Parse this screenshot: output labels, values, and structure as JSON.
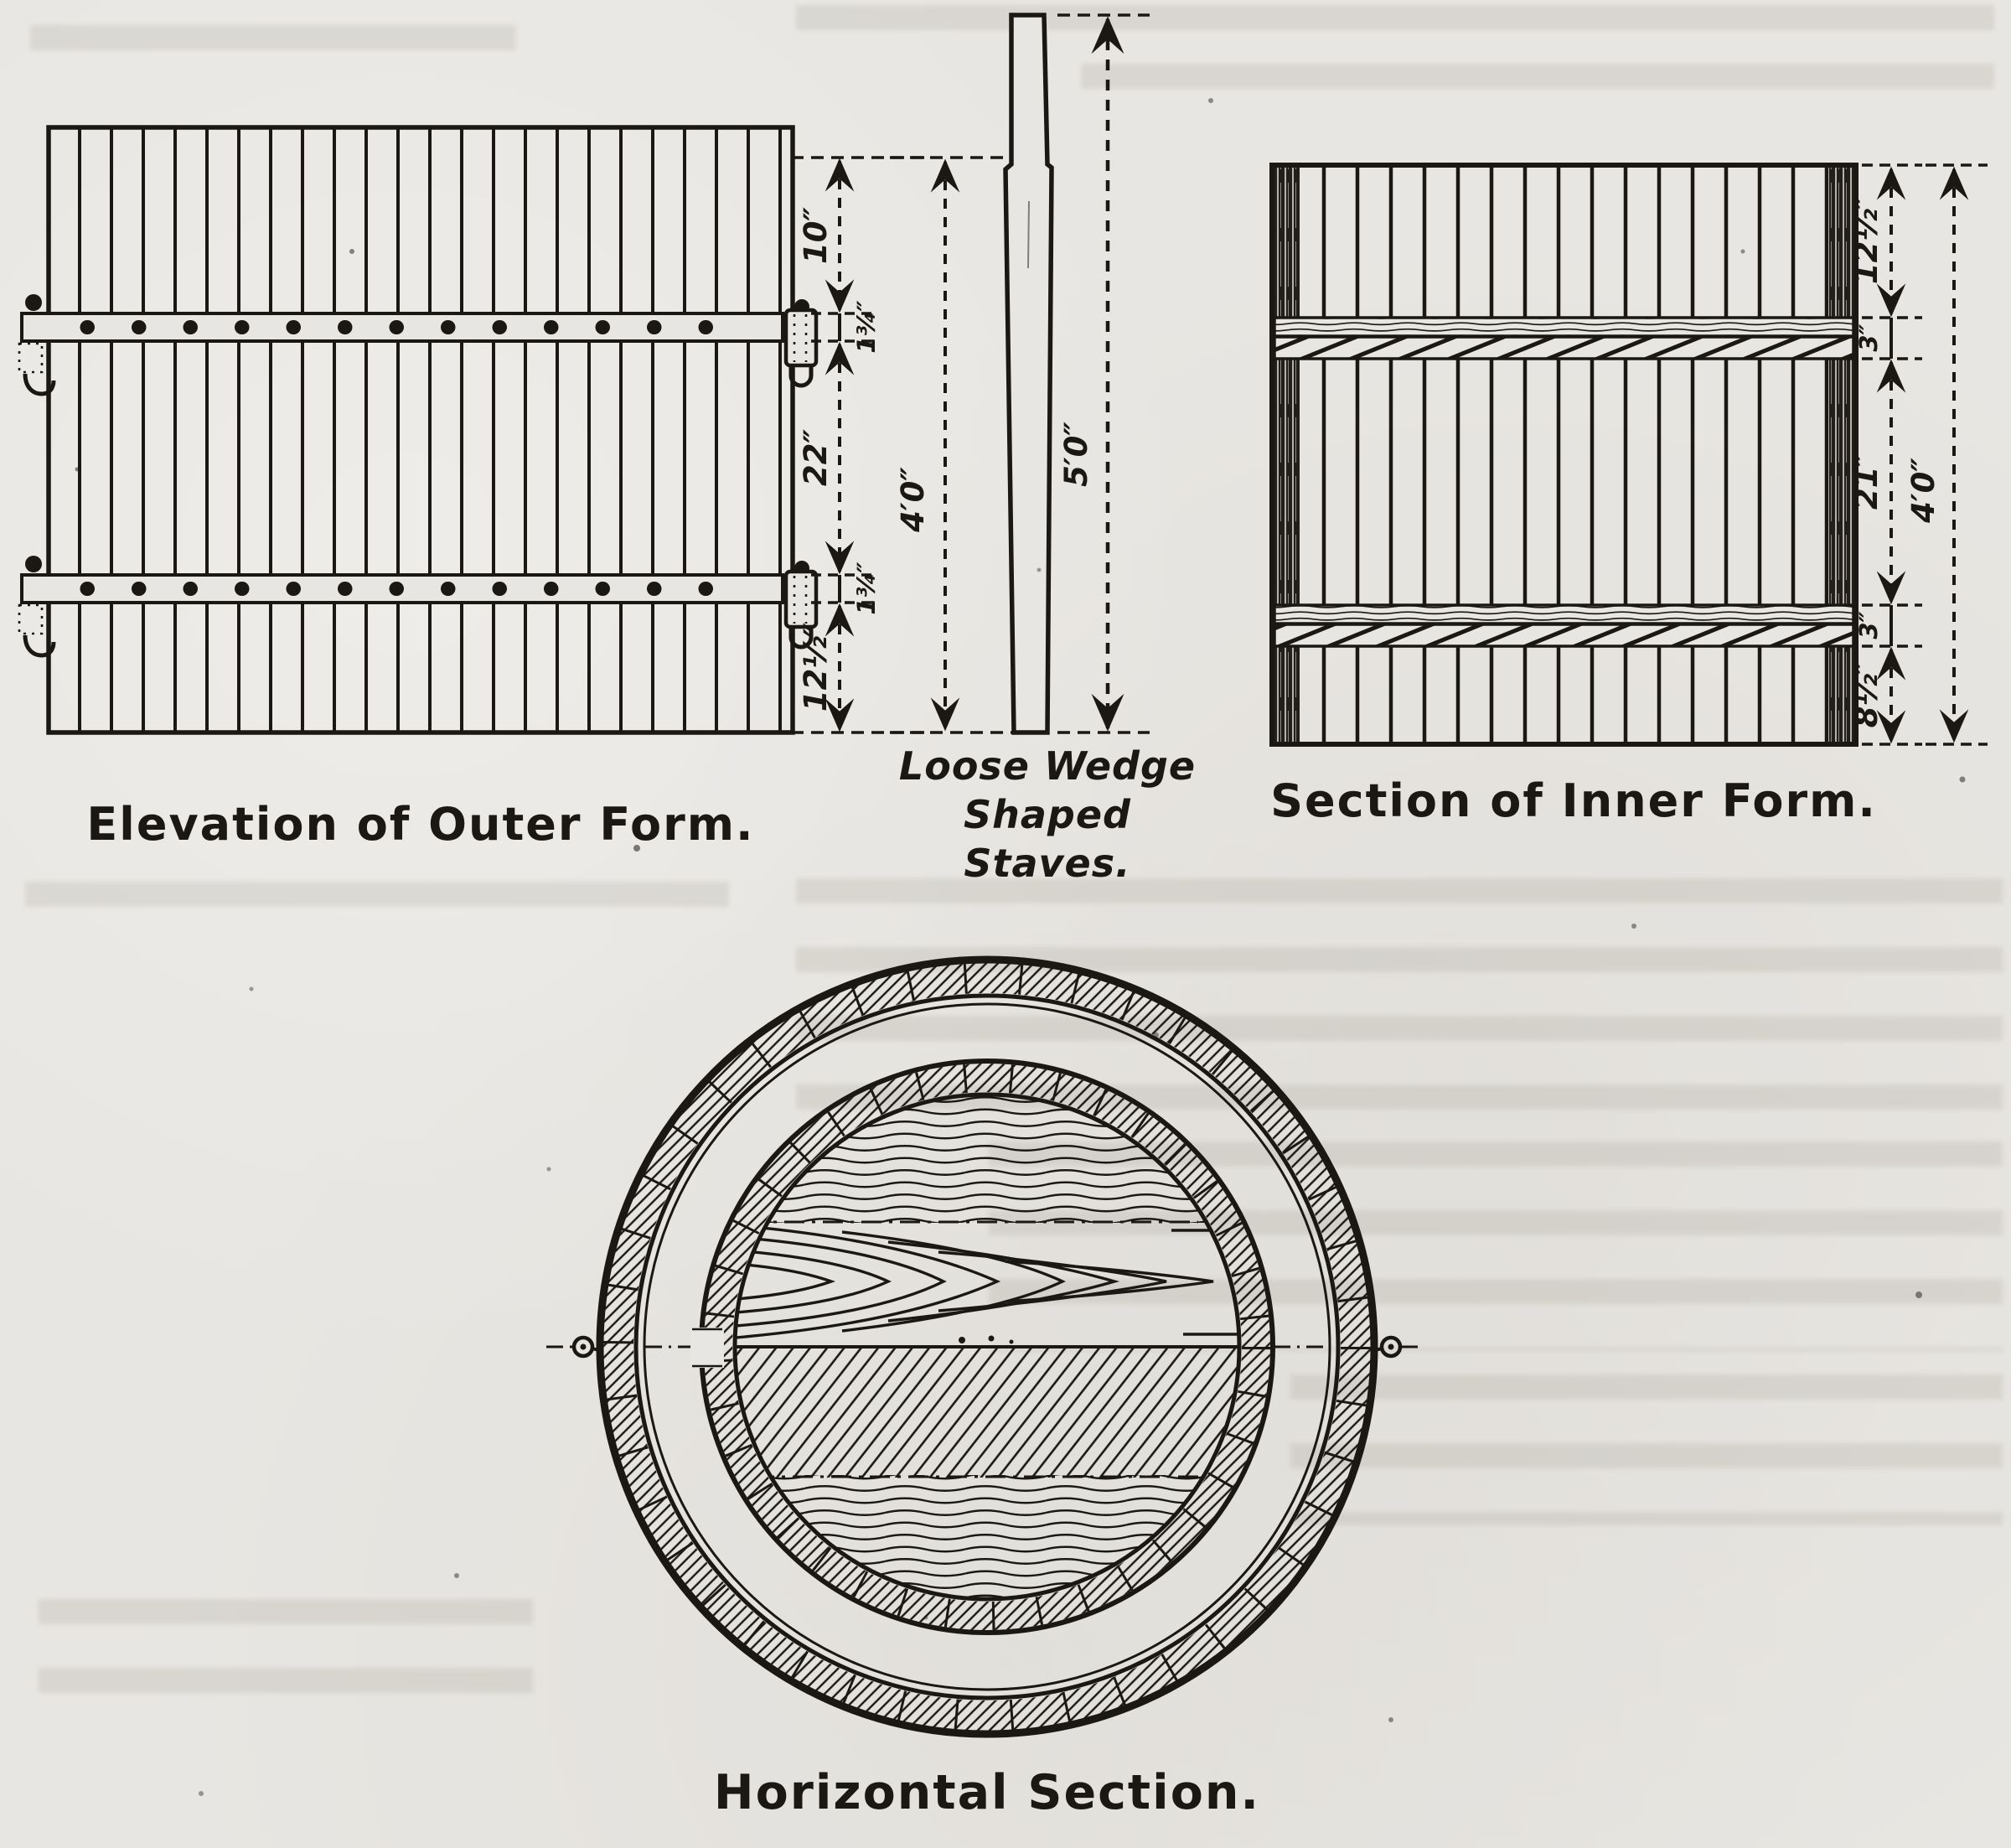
{
  "page": {
    "type": "scanned technical figure",
    "colors": {
      "paper": "#e8e6e2",
      "ink": "#1b1813"
    }
  },
  "figures": {
    "outer_form": {
      "caption": "Elevation of Outer Form.",
      "dims": {
        "seg_top": "10″",
        "batten_upper": "1¾″",
        "seg_middle": "22″",
        "batten_lower": "1¾″",
        "seg_bottom": "12½″",
        "overall_height": "4′0″"
      }
    },
    "stave": {
      "note_lines": [
        "Loose Wedge",
        "Shaped",
        "Staves."
      ],
      "dims": {
        "overall_length": "5′0″"
      }
    },
    "inner_form": {
      "caption": "Section of Inner Form.",
      "dims": {
        "seg_top": "12½″",
        "band_upper": "3″",
        "seg_middle": "21″",
        "band_lower": "3″",
        "seg_bottom": "8½″",
        "overall_height": "4′0″"
      }
    },
    "horizontal_section": {
      "caption": "Horizontal Section."
    }
  }
}
